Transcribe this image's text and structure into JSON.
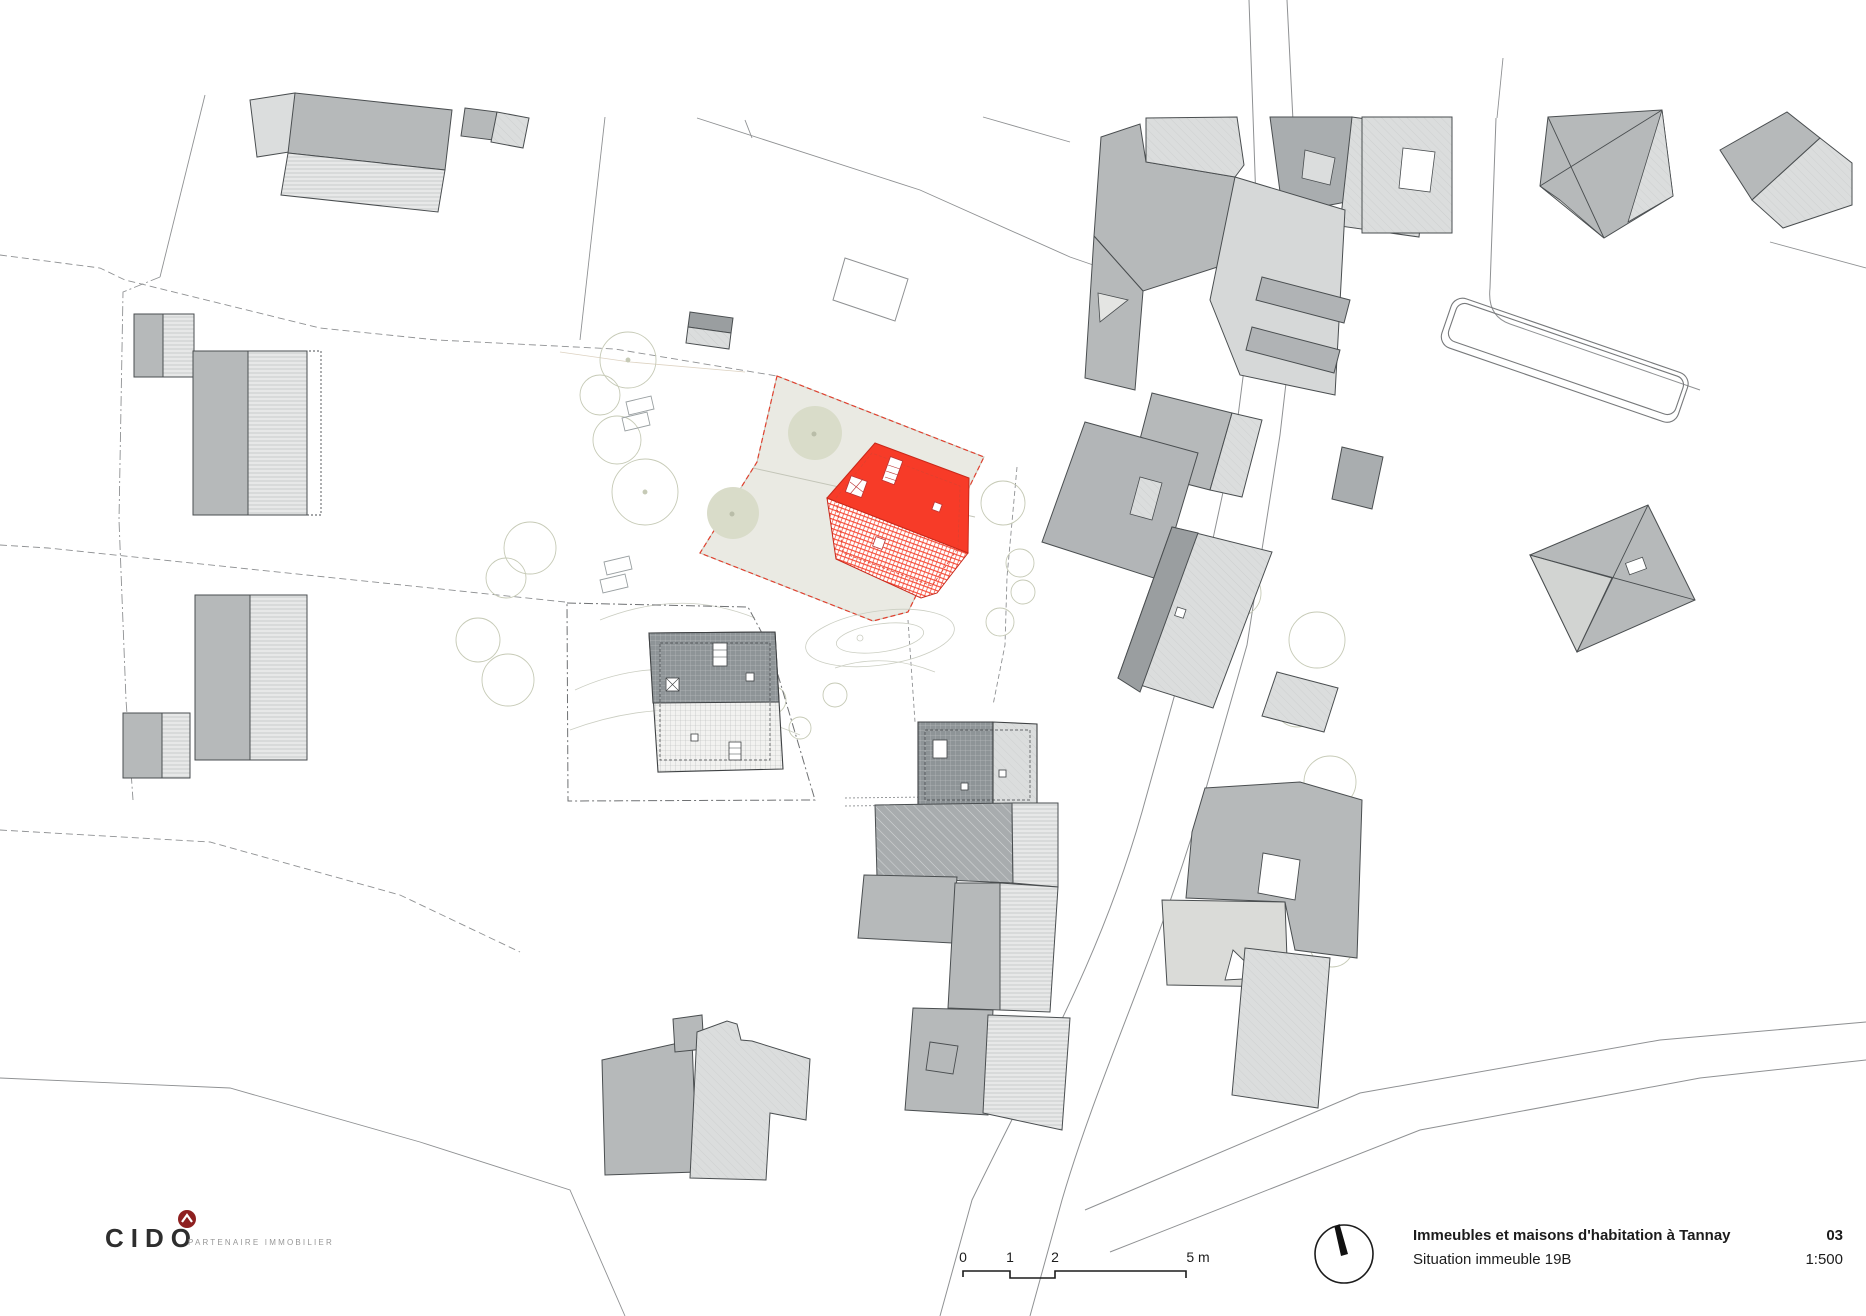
{
  "footer": {
    "logo": {
      "brand": "CIDO",
      "tagline": "PARTENAIRE IMMOBILIER",
      "accent_color": "#8e2020"
    },
    "scalebar": {
      "labels": [
        "0",
        "1",
        "2",
        "5 m"
      ]
    },
    "titleblock": {
      "title": "Immeubles et maisons d'habitation à Tannay",
      "sheet_number": "03",
      "subtitle": "Situation immeuble 19B",
      "scale": "1:500"
    }
  },
  "plan": {
    "highlight_color": "#f73b28",
    "parcel_fill": "#eaeae3",
    "building_medium": "#b6b9ba",
    "building_light": "#dbdddd",
    "building_dark": "#8e9497",
    "tree_fill": "#d9dcc9"
  }
}
